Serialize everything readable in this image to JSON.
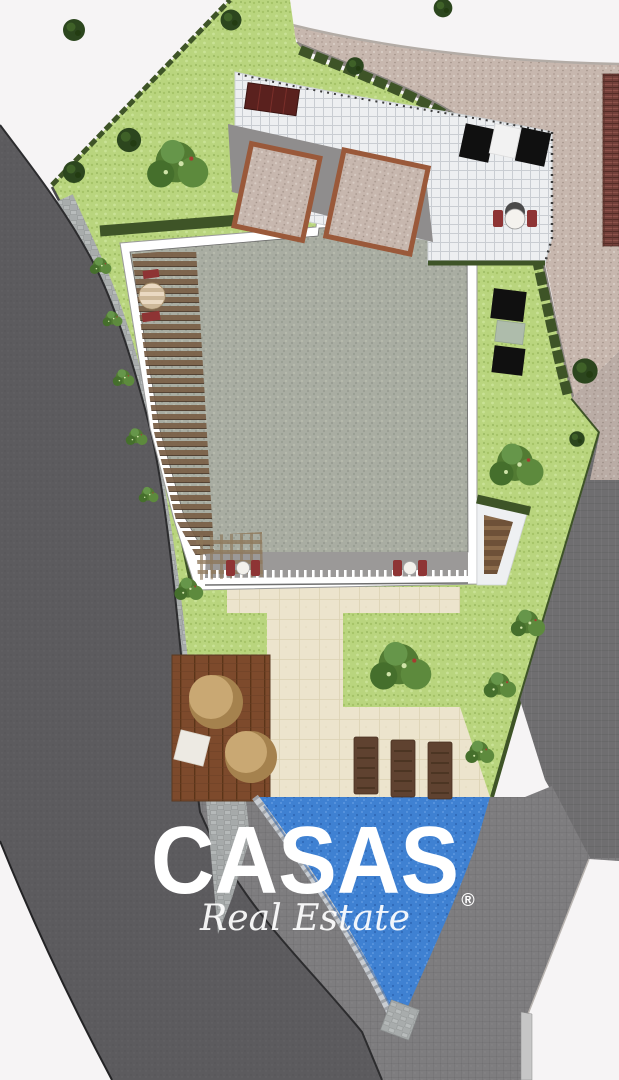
{
  "watermark": {
    "brand": "CASAS",
    "registered": "®",
    "tagline": "Real Estate",
    "color": "#ffffff"
  },
  "colors": {
    "background": "#f6f4f5",
    "road_dark": "#5c5b5e",
    "road_edge": "#2c2c2e",
    "terrain": "#7e7d7f",
    "right_road": "#6f6e70",
    "gravel_road": "#c7b7ae",
    "neighbor_brick": "#74403a",
    "lawn": "#b9d57e",
    "hedge": "#3e5427",
    "tree": "#2c461e",
    "bush": "#527b33",
    "roof": "#a9ada2",
    "building_outline": "#ffffff",
    "patio_tile": "#edeff1",
    "terrace_gravel": "#cfc8bb",
    "terrace_border": "#9a593a",
    "cream_paving": "#ece4cd",
    "deck_wood": "#7d4a2c",
    "deck_chair": "#c9a873",
    "pool_water": "#3f81d2",
    "pool_coping": "#c9cdd2",
    "cobble": "#a8acac",
    "furniture_red": "#8e3434",
    "skylight": "#101010",
    "skylight_sage": "#aebcab",
    "balcony": "#9b9998",
    "lounger_wood": "#5f4230"
  }
}
